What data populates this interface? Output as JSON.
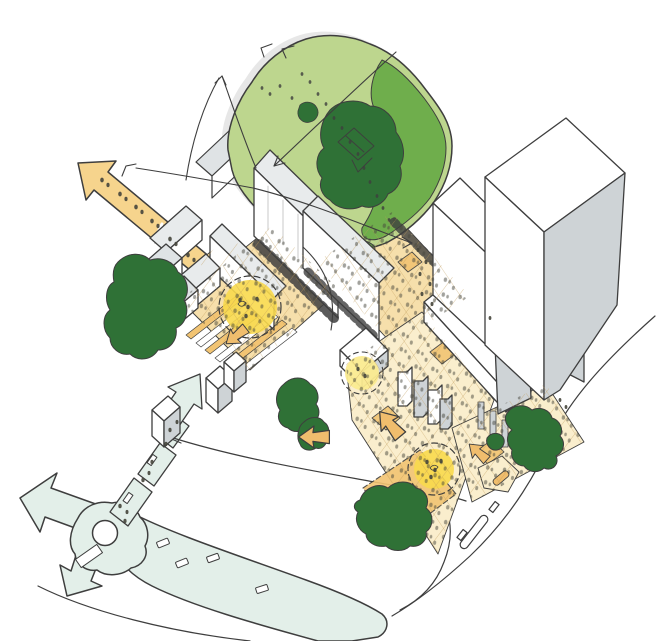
{
  "scene": {
    "type": "hand-drawn axonometric urban masterplan concept sketch",
    "elements": [
      "tree-canopy",
      "dark-tree-groups",
      "hedge-row",
      "white-building-cluster",
      "twin-towers",
      "low-slab-building",
      "small-tower-blocks",
      "public-space-spine",
      "stepped-terraces",
      "activity-nodes",
      "pedestrian-exit-arrow",
      "pedestrian-route",
      "roundabout",
      "street-network",
      "movement-arrows",
      "crowd-dots",
      "annotation-lines"
    ]
  },
  "palette": {
    "ink": "#3e3e3e",
    "paper": "#ffffff",
    "canopy_light": "#bdd68e",
    "canopy_mid": "#6fae4c",
    "canopy_dark": "#2f7136",
    "arrow_tan": "#f6d48d",
    "plaza_pale": "#faeecd",
    "plaza_tan": "#f6dfab",
    "plaza_orange": "#f2c473",
    "arrow_small": "#f0bd6d",
    "node_yellow": "#f8d94d",
    "node_yellow_light": "#fbeb90",
    "road_mint": "#e3efe9",
    "bld_white": "#ffffff",
    "bld_grey": "#ced3d6",
    "roof_grey": "#e8ebec",
    "roof_grey2": "#dfe3e5",
    "shadow": "#c9c9c9",
    "hatch": "#c09a58",
    "crowd": "#45453b"
  }
}
